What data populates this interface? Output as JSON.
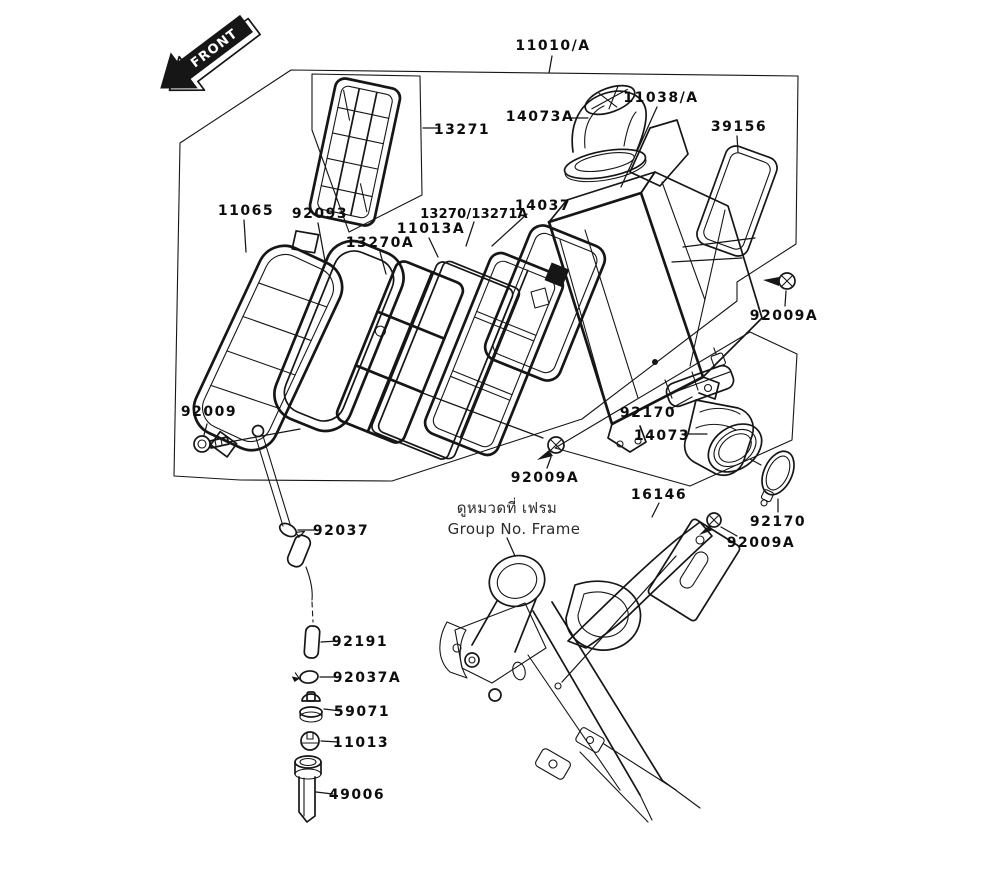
{
  "diagram": {
    "kind": "exploded-parts-diagram",
    "colors": {
      "ink": "#161616",
      "paper": "#ffffff"
    },
    "front_marker": "FRONT",
    "note": {
      "thai": "ดูหมวดที่ เฟรม",
      "english": "Group No. Frame"
    },
    "callouts": [
      {
        "part": "11010/A"
      },
      {
        "part": "13271"
      },
      {
        "part": "14073A"
      },
      {
        "part": "11038/A"
      },
      {
        "part": "39156"
      },
      {
        "part": "11065"
      },
      {
        "part": "92093"
      },
      {
        "part": "13270A"
      },
      {
        "part": "11013A"
      },
      {
        "part": "13270/13271A"
      },
      {
        "part": "14037"
      },
      {
        "part": "92009A"
      },
      {
        "part": "92009"
      },
      {
        "part": "92170"
      },
      {
        "part": "14073"
      },
      {
        "part": "92009A"
      },
      {
        "part": "16146"
      },
      {
        "part": "92170"
      },
      {
        "part": "92009A"
      },
      {
        "part": "92037"
      },
      {
        "part": "92191"
      },
      {
        "part": "92037A"
      },
      {
        "part": "59071"
      },
      {
        "part": "11013"
      },
      {
        "part": "49006"
      }
    ]
  }
}
